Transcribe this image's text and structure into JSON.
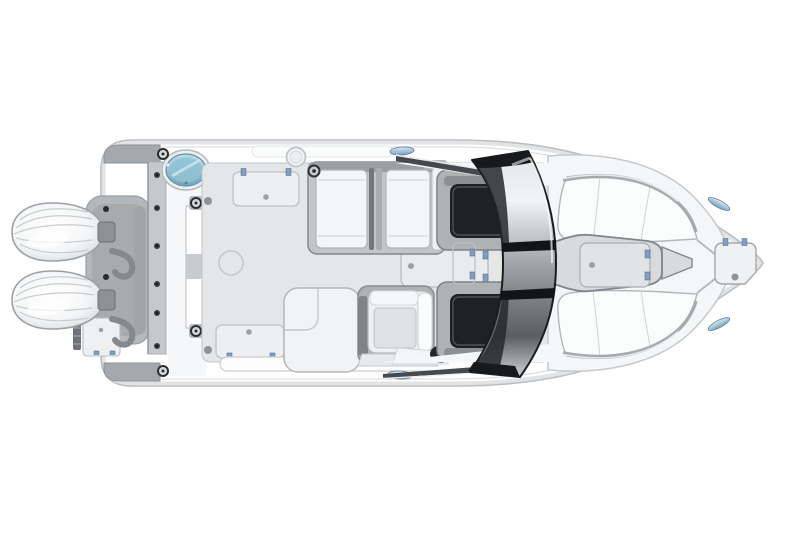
{
  "scene": {
    "type": "photorealistic 3d render",
    "subject": "Overhead top-down deck layout of a dual-console outboard boat",
    "orientation": "bow pointing right, twin outboard engines at stern (left)",
    "background_color": "#ffffff",
    "aria_label": "Top view rendering of a white dual-console boat with twin outboard engines, curved three-panel windshield, helm seat, aft bench, bow lounge cushions and deck storage hatches"
  },
  "components": {
    "engines": {
      "count": 2,
      "label": "twin outboard engine cowls",
      "color": "white with chrome trim"
    },
    "livewell": {
      "label": "oval livewell hatch with translucent blue lid",
      "lid_color": "#8fc2d4"
    },
    "swim_platform": {
      "label": "transom platform with walkthrough door, boarding ladder and step hatch"
    },
    "cockpit_floor": {
      "label": "cockpit sole with flush storage hatches",
      "hatch_count": 4,
      "color": "#e4e6e8"
    },
    "aft_bench": {
      "label": "double bench seat with white cushions and center armrest"
    },
    "wet_bar_module": {
      "label": "L-shaped cockpit module"
    },
    "helm_seat": {
      "label": "helm chair with white upholstery"
    },
    "steering_wheel": {
      "label": "chrome steering wheel"
    },
    "throttle": {
      "label": "black throttle control knob"
    },
    "companion_seats": {
      "count": 2,
      "label": "black-cushion console seats behind windshield"
    },
    "windshield": {
      "label": "curved three-panel wraparound windshield",
      "glass_colors": [
        "#f2f3f4",
        "#8a8e92",
        "#2a2d30"
      ],
      "frame_color": "#17191b"
    },
    "bow_lounges": {
      "count": 2,
      "label": "bow lounge cushions with stainless grab rails"
    },
    "bow_walkway": {
      "label": "center bow walkway with storage hatch"
    },
    "anchor_locker": {
      "label": "anchor locker hatch at bow point"
    },
    "cleats": {
      "count": 4,
      "label": "flush blue-tinted oval cleats",
      "color": "#9fc4da"
    },
    "hinges": {
      "color": "#7fa0c2"
    }
  },
  "palette": {
    "hull_white": "#ffffff",
    "trim_gray": "#b4b8bb",
    "floor_gray": "#e4e6e8",
    "dark_frame": "#1f2123",
    "chrome": "#c6c9cc",
    "accent_blue": "#9fc4da",
    "teal_lid": "#8fc2d4"
  },
  "canvas": {
    "width": 800,
    "height": 533
  }
}
